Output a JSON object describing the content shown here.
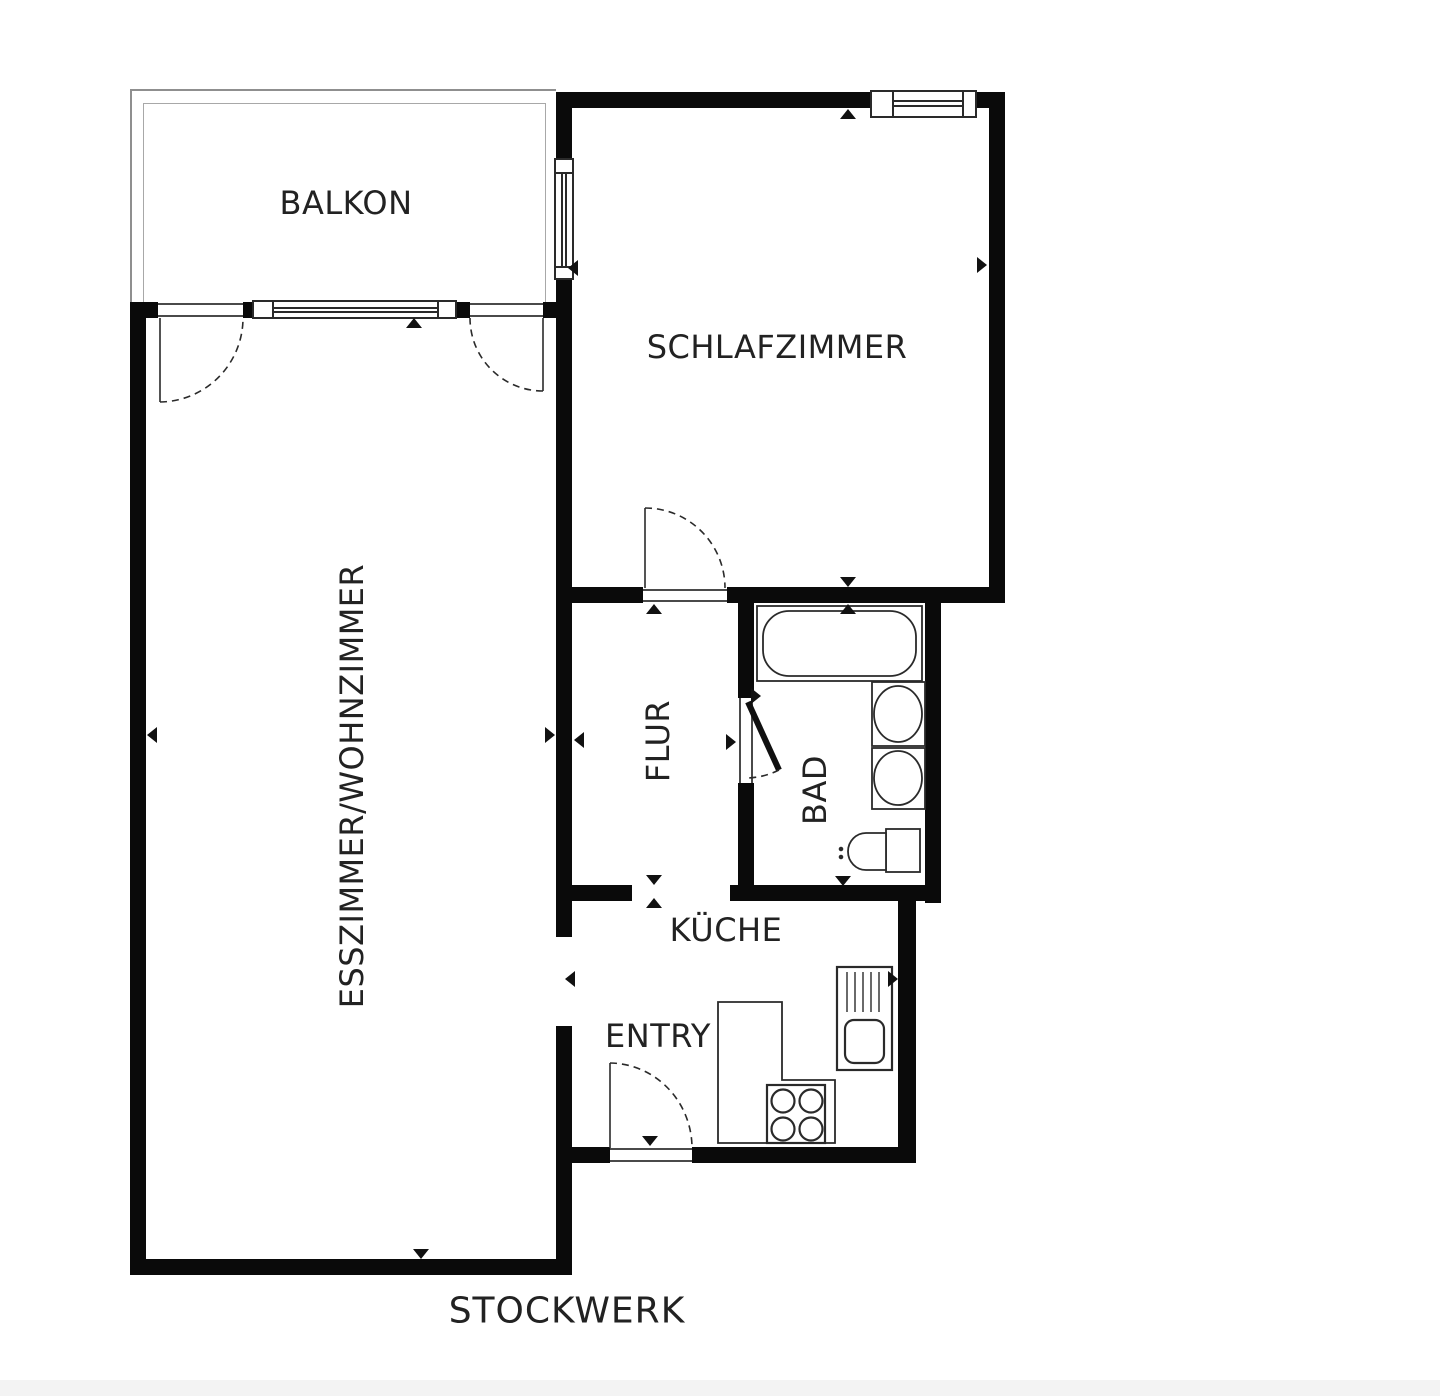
{
  "title": {
    "label": "STOCKWERK"
  },
  "rooms": {
    "balkon": {
      "label": "BALKON"
    },
    "schlafzimmer": {
      "label": "SCHLAFZIMMER"
    },
    "esszimmer_wohnzimmer": {
      "label": "ESSZIMMER/WOHNZIMMER"
    },
    "flur": {
      "label": "FLUR"
    },
    "bad": {
      "label": "BAD"
    },
    "kueche": {
      "label": "KÜCHE"
    },
    "entry": {
      "label": "ENTRY"
    }
  },
  "fixtures": [
    "bathtub",
    "washbasin",
    "washbasin",
    "toilet",
    "kitchen-counter",
    "stove",
    "kitchen-sink"
  ],
  "openings": [
    "balcony-door-left",
    "balcony-window",
    "balcony-door-right",
    "bedroom-window-left",
    "bedroom-window-top",
    "bedroom-door",
    "bathroom-door",
    "flur-kitchen-opening",
    "living-entry-opening",
    "entry-door"
  ],
  "colors": {
    "wall": "#0a0a0a",
    "text": "#222222",
    "fixture_stroke": "#2a2a2a",
    "balcony_outline": "#8f8f8f",
    "background": "#ffffff"
  }
}
